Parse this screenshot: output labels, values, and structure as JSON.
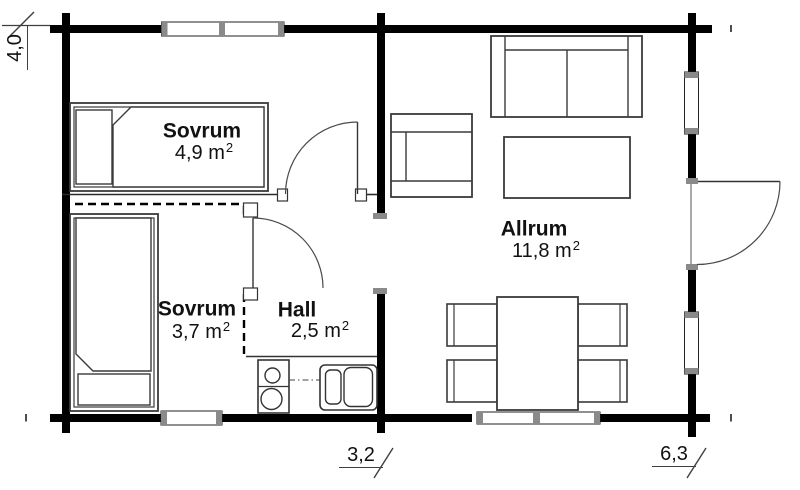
{
  "rooms": {
    "bedroom_top": {
      "label": "Sovrum",
      "area": "4,9 m",
      "area_sup": "2"
    },
    "bedroom_bottom": {
      "label": "Sovrum",
      "area": "3,7 m",
      "area_sup": "2"
    },
    "hall": {
      "label": "Hall",
      "area": "2,5 m",
      "area_sup": "2"
    },
    "living_room": {
      "label": "Allrum",
      "area": "11,8 m",
      "area_sup": "2"
    }
  },
  "dimensions": {
    "height_left": "4,0",
    "width_hall": "3,2",
    "width_living": "6,3"
  },
  "colors": {
    "wall": "#000000",
    "window_jamb": "#8a8a8a",
    "furniture_line": "#3a3a3a",
    "background": "#ffffff",
    "text": "#111111"
  },
  "elements": [
    "exterior-log-walls",
    "interior-wall",
    "dashed-partition",
    "double-window-top",
    "window-bedroom-bottom",
    "double-window-living",
    "window-living-upper",
    "window-living-lower",
    "entry-door",
    "door-bedroom-top",
    "door-bedroom-bottom",
    "bed-top",
    "bed-bottom",
    "sofa",
    "armchair",
    "coffee-table",
    "dining-table",
    "dining-chairs",
    "stove",
    "sink",
    "kitchen-counter",
    "dimension-marks"
  ]
}
